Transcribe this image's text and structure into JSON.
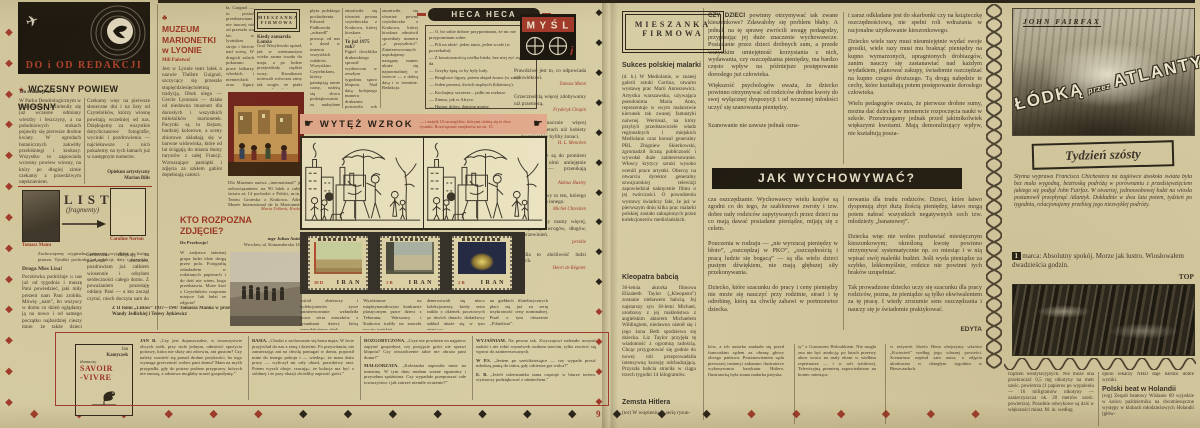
{
  "colors": {
    "paper": "#d7cda4",
    "red": "#9d3326",
    "ink": "#38322a",
    "pink": "#e3aa8e",
    "black": "#1e1a12"
  },
  "icons": {
    "plane": "✈",
    "star": "★",
    "club": "♣",
    "hand_right": "☛",
    "diamond": "◆"
  },
  "page_number": "9",
  "decor": {
    "left_edge": {
      "glyph": "◆",
      "pattern": "rrrrrrrrrrrrr"
    },
    "gutter": {
      "glyph": "◆",
      "pattern": "kkkkkkkkkkrrrr"
    },
    "bottom": {
      "glyph": "◆",
      "pattern": "rrrrrrkkkkkkkkkkrrrrrr"
    }
  },
  "redakcja": {
    "panel_title": "DO i OD REDAKCJI",
    "headline": "WCZESNY POWIEW WIOSNY",
    "kicker": "Do redakcji nr 1",
    "col1": "W Parku Dendrologicznym w Przelewicach zazieleniły się już wczesne odmiany wierzby i leszczyny, a na południowych stokach pojawiły się pierwsze drobne kwiaty. W ogrodach botanicznych zakwitły przebiśniegi i krokusy. Wszystko to zapowiada wczesny powiew wiosny, na który po długiej zimie czekamy z prawdziwym utęsknieniem.",
    "col2": "Czekamy więc na pierwsze słoneczne dni i na listy od Czytelników, którzy wiosnę powitają wcześniej od nas. Dziękujemy za wszystkie dotychczasowe fotografie, wycinki i pozdrowienia — najciekawsze z nich pokażemy na tych łamach już w następnym numerze.",
    "sig1": "Opiekun artystyczny",
    "sig2": "Marian Bilis"
  },
  "listy": {
    "title": "LISTY",
    "subtitle": "(fragmenty)",
    "name1": "Tomasz Mann",
    "name2": "Caroline Norton",
    "intro": "Zachowujemy oryginalną pisownię wyjątków z listów pisarza. Tytuliki pochodzą od redakcji; daty i nazwiska adresatów podajemy w nawiasach.",
    "salutation": "Droga Miss Lisa!",
    "col1": "Pocztówka podróżuje u nas już od tygodnia i muszę Pani powiedzieć, jaki miły prezent nam Pani zrobiła. Mówię „nam”, bo wszyscy w domu co dzień oglądamy ją na nowo i od samego początku najbardziej cieszy mnie, że także dzieci reagują na jej dobroć i prostotę.",
    "col2": "Serdecznie dziękuję za pierwsze obietnice, pozdrawiam już całkiem wiosennie i odsyłam serdeczności całego domu. Z poważaniem pozostaję oddany Pani — a kto zaczął czytać, niech doczyta sam do końca.",
    "caption": "Z II tomu „Listów” 1937—1947 Tomasza Manna w przekładzie Wandy Jedlickiej i Teresy Jętkiewicz"
  },
  "savoir": {
    "a1": "Jan",
    "a2": "Kamyczek",
    "mid": "tłumaczy",
    "t1": "SAVOIR",
    "t2": "-VIVRE"
  },
  "qa": {
    "col1": [
      {
        "lead": "JAN B.",
        "text": "„Czy jest dopuszczalne, w towarzystwie obcych osób, przy stole jednym, odmówić spożycia potrawy, która nie służy ani zdrowiu, ani gustom? Czy należy wznieść się ponad drobne przykrości, bo tego wymaga grzeczność wobec pani domu? Mam na myśli przypadki, gdy do potraw podano przyprawy, których nie znoszę, a odmowa mogłaby urazić gospodynię.”"
      }
    ],
    "col2": [
      {
        "lead": "BASIA.",
        "text": "„Chodzi o zachowanie się brata męża. W lecie przyjechał do nas z żoną i dziećmi. Po przywitaniu, nie zamierzając ani na chwilę pomagać w domu, poprosił mnie do innego pokoju i — wiedząc, że mam dużo pracy — wyliczył mi cały obiad, prawdziwy raut. Potem wyszli oboje, rzucając, że kolacja ma być o siódmej i że przy okazji chcieliby zaprosić gości.”"
      }
    ],
    "col3": [
      {
        "lead": "ROZGORYCZONA.",
        "text": "„Czyż nie powinien on najpierw zapytać gospodyni, czy przyjęcie gości nie sprawi kłopotu? Czy oświadczenie takie nie obraża pani domu?”"
      },
      {
        "lead": "MAŁGORZATA.",
        "text": "„Koleżanka zaprosiła mnie na imieniny. W tym dniu miałam ważne egzaminy i przyszłam spóźniona. Czy wypadało przepraszać całe towarzystwo i jak zatrzeć niemiłe wrażenie?”"
      }
    ],
    "col4": [
      {
        "lead": "WYJAŚNIAM.",
        "text": "Na pewno tak. Zwyczajowi należało uczynić zadość i nie robić wymówek osobom trzecim, tylko zwrócić się wprost do zainteresowanych."
      },
      {
        "lead": "W P.S.",
        "text": "„Jestem po sześćdziesiątce — czy wypada prosić młodszą panią do tańca, gdy orkiestra gra walca?”"
      },
      {
        "lead": "E. B.",
        "text": "„Jeżeli solenizantka sama częstuje w biurze tortem, wystarczy podziękować z uśmiechem.”"
      }
    ]
  },
  "muzeum": {
    "title1": "MUZEUM",
    "title2": "MARIONETKI",
    "title3": "w LYONIE",
    "kicker": "Mili Państwo!",
    "col1": "Jest w Lyonie teatr lalek o nazwie Théâtre Guignol, szczycący się przeszło stupięćdziesięcioletnią tradycją. Obok niego — Cercle Lyonnais — działa od niedawna muzeum dla dorosłych i wszystkich miłośników marionetek. Pacynki są tu lżejsze, bardziej kolorowe, a sceny zbiorowe układają się w barwne widowiska, które od lat ściągają do miasta tłumy turystów z całej Francji. Wzruszające pamiątki i zdjęcia za szkłem gablot dopełniają całości.",
    "col2": "ła, Guignol — to postać przedstawiana nie inaczej niż od przeszło stu lat: w lyońskim stroju i birecie nad sceną. W drugich salach pokazano prace lalkarzy włoskich i niemieckich oraz figury „La Scali” wykonane dla dzieci.",
    "below": "Dla Muzeum nazwa „international” jest zobowiązaniem: na 90 lalek z całego świata aż 14 pochodzi z Polski, m.in. z Teatru Groteska z Krakowa. Adres: Musée International de la Marionnette, rue de Gadagne, Lyon, France.",
    "sig": "Maria Tolkmit, Kraków"
  },
  "mini_mieszanka": {
    "box1": "MIESZANKA",
    "box2": "FIRMOWA",
    "head": "Kiedy zamarzła Łomża",
    "body": "Graf Wasylewski opisał, jak w osiemnastym wieku sanna trwała do maja, a po lodzie przejeżdżały ciężkie wozy. Kronikarze notowali wówczas zimy tak srogie, że ptaki zamarzały w locie."
  },
  "kto": {
    "t1": "KTO ROZPOZNA",
    "t2": "ZDJĘCIE?",
    "kicker": "Do Przekroju!",
    "body": "W zadymce śnieżnej grupa ludzi idzie drogą przez pola. Fotografię odnalazłem w rodzinnych papierach i do dziś nie wiem, kogo przedstawia. Może ktoś z Czytelników rozpozna miejsce lub ludzi ze zdjęcia?",
    "sig1": "mgr Julian Aniok",
    "sig2": "Wrocław, ul. Komandorska 141"
  },
  "center_cols": {
    "a": "płyta polskiego pochodzenia. Edward Fiałkowski „odszedł” prosząc od nas o dział w imieniu wszystkich rodaków. Wszystkim Czytelnikom, którzy pamiętają tamte czasy, należą się słowa podziękowania za nadsyłane wspomnienia, wycinki i fotografie sprzed lat.",
    "b_head": "To już 1975 rok?",
    "b": "Figiel chochlika drukarskiego sprawił wydawcom w zeszłym tygodniu sporo kłopotu. Nad datą kolejnego numeru drukarnia postawiła rok 1975 zamiast 1969 i nikt tego nie zauważył, aż pierwsi Czytelnicy zaczęli nadsyłać listy z pytaniem, czy redakcja nie wybiera się w podróż w czasie.",
    "c": "zmartwiła się również pewna czytelniczka z Krakowa, której kioskarz odmówił sprzedaży numeru „z przyszłości”. Zainteresowanych uspokajamy: następny numer ukaże się najnormalniej w świecie — z dobrą datą i w terminie. Redakcja."
  },
  "heca": {
    "title": "HECA HECA",
    "lines": [
      "— O, bo sobie dobrze przypominam, że nic nie przypominam sobie.",
      "— Pili na złość: jeden tanio, jeden wcale (w poczekalni).",
      "— Z kosztownością wielka bieda, bez niej żyć się nie da.",
      "— Grzyby śpią, to by były ludy.",
      "— Bezgłowe figury, potem złapał żuraw (w zoo).",
      "— Jeden prezent, dwóch mądrych (bliźniacy).",
      "— Kochajmy szczerze... jadło na rozkurz.",
      "— Zimno, jak w Afryce.",
      "— Humor dobry, dansing marny.",
      "— Mąż, żona, mózg można mieć wspólny (u krewnych)."
    ],
    "footer": "Wynotowali z listów i prasy Czytelnicy: Jadwiga W. z Warszawy, K. B. z Gniezna, Tadeusz M. i Wiesława C. z Wrocławia, Krystyna P. z Katowic. Podziękowania i pozdrowienia!"
  },
  "mysl": {
    "logo": "M Y Ś L",
    "i": "i",
    "quotes": [
      {
        "t": "Prawdziwe jest to, co odpowiada człowiekowi.",
        "a": "Tomasz Mann"
      },
      {
        "t": "Grzecznością więcej zdobywamy niż przemocą.",
        "a": "Fryderyk Chopin"
      },
      {
        "t": "Niektórzy znacznie więcej wiedzą o kobietach niż kobiety — inaczej także byliby żonaci.",
        "a": "H. L. Mencken"
      },
      {
        "t": "Słowa podobne są do promieni X. Jeśli się nimi umiejętnie posługiwać — przenikają wszystko.",
        "a": "Aldous Huxley"
      },
      {
        "t": "Człowiek zdrowy to ten, którego co dzień boli co innego.",
        "a": "Michel Chrestien"
      },
      {
        "t": "Czterech rzeczy mamy więcej, niż myślimy: wrogów, długów, lat i przewinień.",
        "a": "perskie"
      },
      {
        "t": "Perfidia to złośliwość ludzi słabych.",
        "a": "Henri de Régnier"
      }
    ]
  },
  "wytez": {
    "title": "WYTĘŻ WZROK",
    "note": "— i znajdź 10 szczegółów, którymi różnią się te dwa rysunki. Rozwiązanie znajdziesz na str. 15."
  },
  "stamps": {
    "country": "IRAN",
    "s1": "50 D",
    "s2": "1 R",
    "s3": "2 R",
    "notes": [
      "wśród zbieraczy i kolekcjonerów żywe zainteresowanie wzbudziła nowa seria znaczków z rysunkami dzieci, którą reprodukujemy obok.",
      "Wyróżnione na międzynarodowym konkursie plastycznym prace dzieci z Teheranu, Warszawy i Krakowa trafiły na znaczki poczty irańskiej.",
      "denerwowali się nieco kolekcjonerzy, kiedy seria znikła z okienek pocztowych po dwóch dniach; dodatkowy nakład ukaże się w tym miesiącu.",
      "na giełdach filatelistycznych płaci się już za serię trzykrotność ceny nominalnej. Pisał o tym obszernie „Filatelista”."
    ]
  },
  "mieszanka": {
    "box1": "MIESZANKA",
    "box2": "FIRMOWA",
    "a1t": "Sukces polskiej malarki",
    "a1b": "(d. h.) W Mediolanie, w znanej galerii sztuki Cortina, otwarto wystawę prac Marii Antoszewicz. Artystka warszawska, używająca pseudonimu Maria Anto, reprezentuje w swym malarstwie kierunek tak zwanej fantastyki naiwnej. Wernisaż, na który przybyli przedstawiciele władz regionalnych i miejskich Mediolanu oraz konsul generalny PRL Zbigniew Skierkowski, zgromadził liczną publiczność i wywołał duże zainteresowanie. Włoscy krytycy sztuki wysoko ocenili prace artystki. Obecny na otwarciu dyrektor generalny szwajcarskiej telewizji zapowiedział nakręcenie filmu o jej twórczości. O powodzeniu wystawy świadczy fakt, że już w pierwszym dniu kilka prac malarki polskiej zostało zakupionych przez kolekcjonerów mediolańskich.",
    "a2t": "Kleopatra babcią",
    "a2b": "36-letnia aktorka filmowa Elizabeth Taylor („Kleopatra”) zostanie niebawem babcią. Jej najstarszy syn 18-letni Michael, urodzony z jej małżeństwa z angielskim aktorem Michaelem Wildingiem, niedawno ożenił się i jego żona Beth spodziewa się dziecka. Liz Taylor przyjęła tę wiadomość z ogromną radością. Chcąc przygotować się godnie do nowej roli przeprowadziła intensywną kurację odchudzającą. Przyszła babcia straciła w ciągu trzech tygodni 14 kilogramów.",
    "a3t": "Zemsta Hitlera",
    "a3b": "(tor) W więzieniu za serię rysun-",
    "a3cont": "ków, a ich autorka znalazła się przed francuskim sądem za obrazę głowy obcego państwa. Postanowieniem sądu pierwszej instancji zakazano ilustratorce wykonywania karykatur Hitlera. Ilustratorką była znana malarka paryska."
  },
  "wych": {
    "lead_strong": "CZY DZIECI",
    "lead": " powinny otrzymywać tak zwane kieszonkowe? Zdawałoby się problem błahy. A jednak na tę sprawę zwrócili uwagę pedagodzy, przypisując jej duże znaczenie wychowawcze. Posiadanie przez dzieci drobnych sum, a przede wszystkim umiejętność korzystania z nich, wydawania, czy oszczędzania pieniędzy, ma bardzo często wpływ na późniejsze postępowanie dorosłego już człowieka.",
    "p2": "Większość psychologów uważa, że dziecko powinno otrzymywać od rodziców drobne kwoty do swej wyłącznej dyspozycji i od wczesnej młodości uczyć się szanowania pieniędzy.",
    "p3": "Szanowanie nie zawsze jednak ozna-",
    "c2p1": "i zaraz odkładane jest do skarbonki czy na książeczkę oszczędnościową, nie spełni roli wdrażania w racjonalne użytkowanie kieszonkowego.",
    "c2p2": "Dziecko wiele razy musi nieumiejętnie wydać swoje grosiki, wiele razy musi mu braknąć pieniędzy na kupno wymarzonych, upragnionych drobiazgów, zanim nauczy się zastanawiać nad każdym wydatkiem, planować zakupy, świadomie oszczędzać na kupno czegoś droższego. Tą drogą nabędzie te cechy, które kształtują potem postępowanie dorosłego człowieka.",
    "c2p3": "Wielu pedagogów uważa, że pierwsze drobne sumy, można dać dziecku w momencie rozpoczęcia nauki w szkole. Przestrzegamy jednak przed jakimikolwiek większymi kwotami. Mają demoralizujący wpływ, nie kształtują posza-",
    "banner": "JAK WYCHOWYWAĆ?",
    "b1": "cza oszczędzanie. Wychowawcy wielu krajów są zgodni co do tego, że szablonowe zwroty i tzw. dobre rady rodziców zapytywanych przez dzieci na co mają dawać posiadane pieniądze, mijają się z celem.\n\nPouczenia w rodzaju — „nie wyrzucaj pieniędzy w błoto”, „oszczędzaj w PKO”, „oszczędnością i pracą ludzie się bogacą” — są dla wielu dzieci pustym dźwiękiem, nie mają głębszej siły przekonywania.\n\nDziecko, które szacunku do pracy i ceny pieniędzy nie może się nauczyć przy rodzinie, straci i tę odrobinę, którą na chwilę zabawi w portmonetce dziecka.",
    "b2": "nowania dla trudu rodziców. Dzieci, które łatwo dysponują zbyt dużą ilością pieniędzy, łatwo mogą potem nabrać wszystkich negatywnych cech tzw. młodzieży „bananowej”.\n\nDziecka więc nie wolno pozbawiać miesięcznym kieszonkowym; określoną kwotę powinno otrzymywać systematycznie np. co miesiąc i w nią wpisać swój maleńki budżet. Jeśli wyda pieniądze za szybko, lekkomyślnie, rodzice nie powinni tych braków uzupełniać.\n\nTak prowadzone dziecko uczy się szacunku dla pracy rodziców, pozna, że pieniądze są tylko ekwiwalentem za tę pracę. I wtedy zrozumie sens oszczędzania i nauczy się je świadomie praktykować.",
    "sig": "EDYTA"
  },
  "kultura": {
    "c2": "ty” z Gustawem Holoubkiem. Nie mogła ona nie być atrakcją: po latach przerwy aktor wraca na mały ekran w wielkim repertuarze — i w roli tytułowej. Telewizyjną premierę zapowiedziano na koniec miesiąca.",
    "c3": "w reżyserii Józefa Hena obejrzymy wkrótce „Kwiecień” według jego własnej powieści. Scenariusz napisał sam autor, a zdjęcia ukończono w ubiegłym tygodniu w Bieszczadach."
  },
  "atlantyk": {
    "byline": "JOHN FAIRFAX",
    "t1": "ŁÓDKĄ",
    "mid": "przez",
    "t2": "ATLANTYK",
    "box": "Tydzień szósty",
    "intro": "Słynna wyprawa Francisca Chichestera na żaglówce dookoła świata była bez mała wygodną, beztroską podróżą w porównaniu z przedsięwzięciem jakiego się podjął John Fairfax. W otwartej, jednoosobowej łodzi na wiosła postanowił przepłynąć Atlantyk. Dokładnie w dwa lata potem, tydzień po tygodniu, relacjonujemy przebieg jego niezwykłej podróży.",
    "day": "1",
    "log": "marca: Absolutny spokój. Morze jak lustro. Wiosłowałem dwadzieścia godzin.",
    "sig": "TOP"
  },
  "holandia": {
    "col1": "rządzeń wentylacyjnych. Nie może ona przekraczać 0,5 mg nikotyny na metr sześc. powietrza (1 papieros po wypaleniu — 16 miligramów nikotyny — zanieczyszcza ok. 20 metrów sześc. powietrza). Poradnie odwykowe są dziś w większości miast. M. in. według",
    "intro2": "opinii lekarzy NHD daje bardzo dobre wyniki.",
    "head": "Polski beat w Holandii",
    "body": "(rog) Zespół beatowy Wiślanie 69 wyjedzie w końcu października na dwumiesięczne występy w klubach młodzieżowych Holandii (głów-"
  }
}
